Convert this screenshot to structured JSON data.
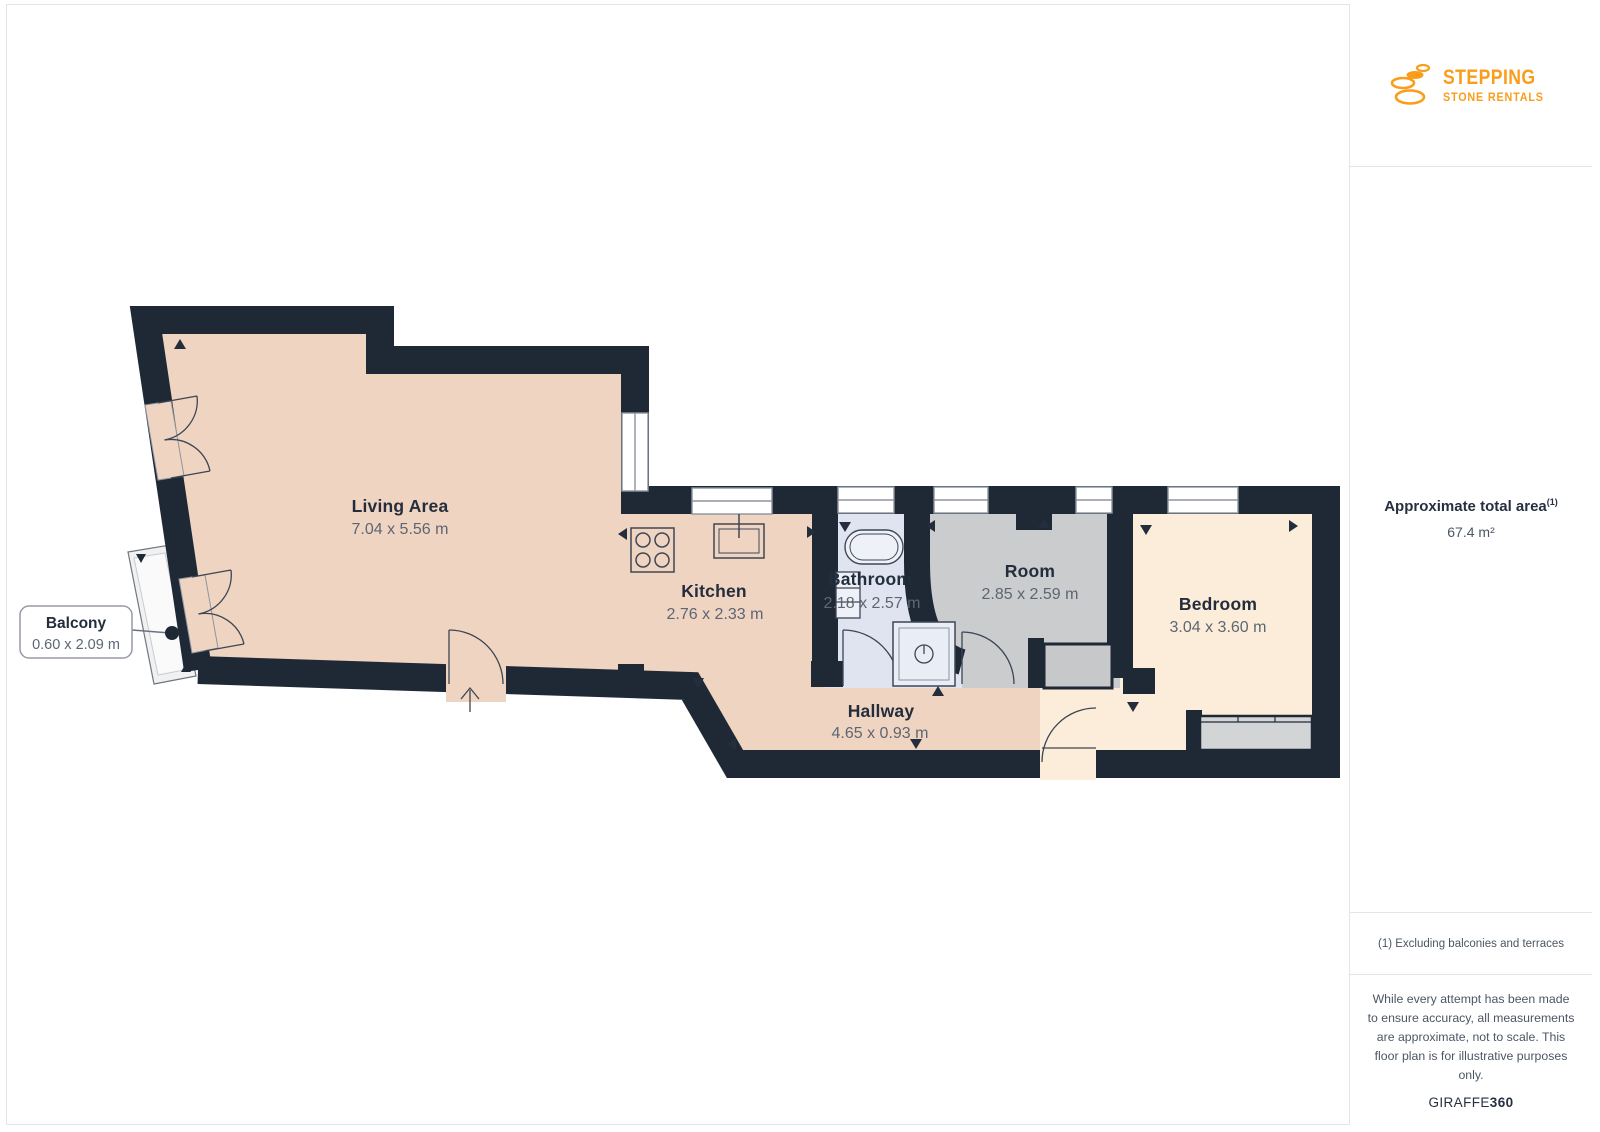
{
  "branding": {
    "logo_line1": "STEPPING",
    "logo_line2": "STONE RENTALS",
    "logo_color": "#f99d1b"
  },
  "sidebar": {
    "area_label": "Approximate total area",
    "area_superscript": "(1)",
    "area_value": "67.4 m²",
    "footnote": "(1) Excluding balconies and terraces",
    "disclaimer": "While every attempt has been made to ensure accuracy, all measurements are approximate, not to scale. This floor plan is for illustrative purposes only.",
    "watermark_regular": "GIRAFFE",
    "watermark_bold": "360"
  },
  "floorplan": {
    "rooms": [
      {
        "name": "Living Area",
        "dimensions": "7.04 x 5.56 m"
      },
      {
        "name": "Kitchen",
        "dimensions": "2.76 x 2.33 m"
      },
      {
        "name": "Bathroom",
        "dimensions": "2.18 x 2.57 m"
      },
      {
        "name": "Room",
        "dimensions": "2.85 x 2.59 m"
      },
      {
        "name": "Bedroom",
        "dimensions": "3.04 x 3.60 m"
      },
      {
        "name": "Hallway",
        "dimensions": "4.65 x 0.93 m"
      },
      {
        "name": "Balcony",
        "dimensions": "0.60 x 2.09 m"
      }
    ],
    "colors": {
      "wall": "#1f2936",
      "living_kitchen_hallway": "#f0d4c2",
      "bathroom": "#dfe4f0",
      "room": "#caccce",
      "bedroom": "#fcedda",
      "balcony": "#f1f1f1",
      "label_dark": "#232d3c",
      "label_dim": "#5d6673"
    }
  }
}
